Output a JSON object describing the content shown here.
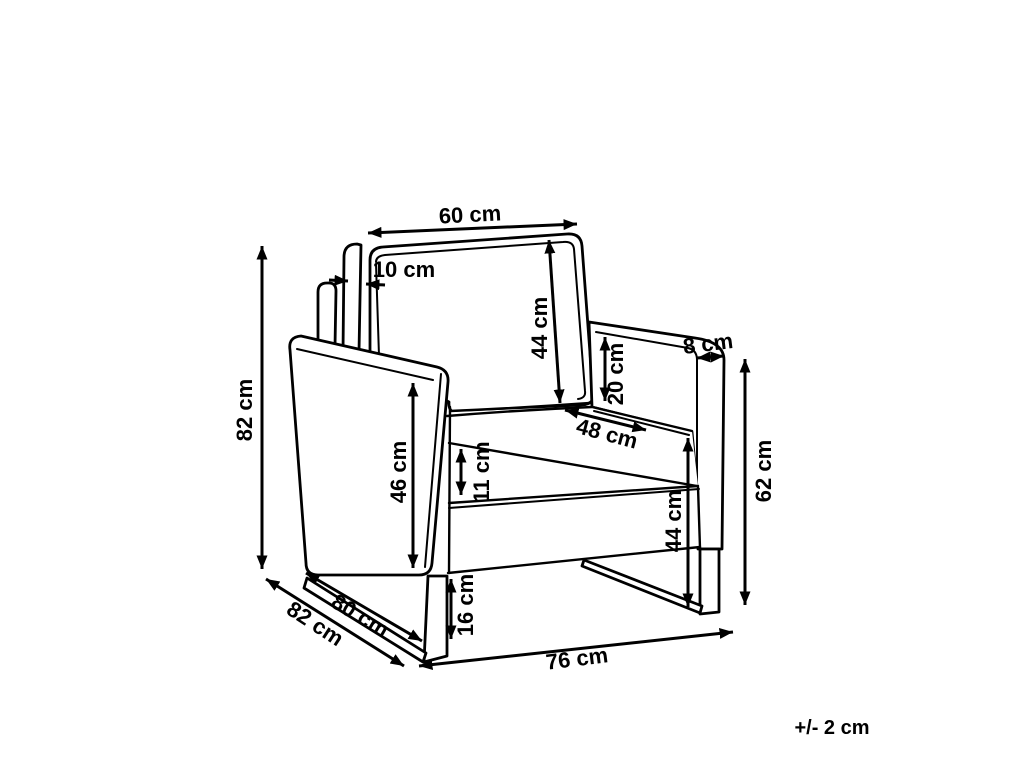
{
  "diagram": {
    "type": "furniture-dimension-diagram",
    "product": "armchair",
    "units": "cm",
    "tolerance_note": "+/- 2 cm",
    "dims": [
      {
        "id": "back-width",
        "label": "60 cm",
        "value": 60
      },
      {
        "id": "backrest-thickness",
        "label": "10 cm",
        "value": 10
      },
      {
        "id": "backrest-height",
        "label": "44 cm",
        "value": 44
      },
      {
        "id": "backrest-above-armrest",
        "label": "20 cm",
        "value": 20
      },
      {
        "id": "armrest-width",
        "label": "8 cm",
        "value": 8
      },
      {
        "id": "overall-height",
        "label": "82 cm",
        "value": 82
      },
      {
        "id": "side-panel-height",
        "label": "46 cm",
        "value": 46
      },
      {
        "id": "seat-depth",
        "label": "48 cm",
        "value": 48
      },
      {
        "id": "seat-cushion-thickness",
        "label": "11 cm",
        "value": 11
      },
      {
        "id": "seat-height",
        "label": "44 cm",
        "value": 44
      },
      {
        "id": "armrest-height",
        "label": "62 cm",
        "value": 62
      },
      {
        "id": "leg-clearance-height",
        "label": "16 cm",
        "value": 16
      },
      {
        "id": "overall-depth",
        "label": "82 cm",
        "value": 82
      },
      {
        "id": "base-runner-depth",
        "label": "80 cm",
        "value": 80
      },
      {
        "id": "overall-width",
        "label": "76 cm",
        "value": 76
      }
    ]
  }
}
